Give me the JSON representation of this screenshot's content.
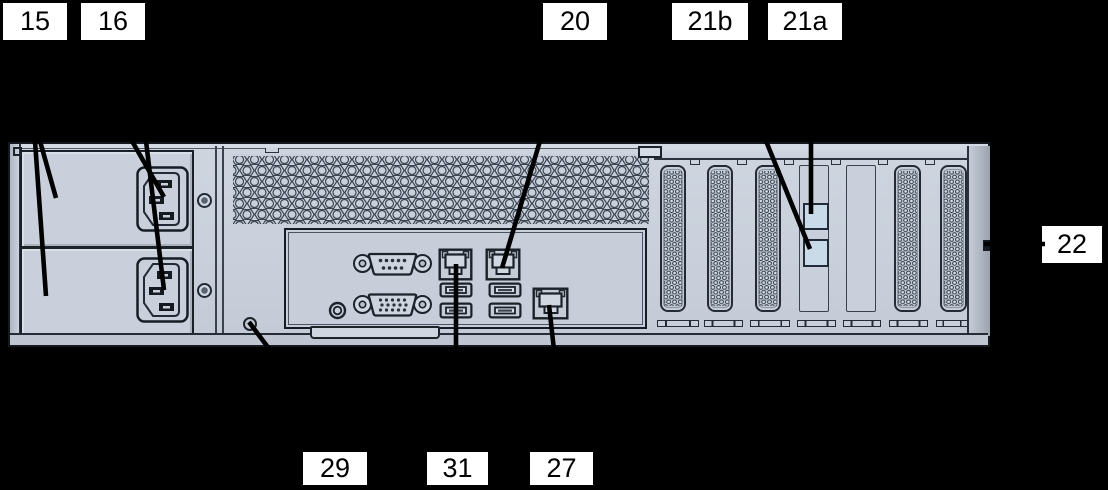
{
  "figure": {
    "kind": "server rear panel callout diagram"
  },
  "colors": {
    "background": "#000000",
    "chassis_fill": "#c9d0db",
    "outline": "#1d232b",
    "shade": "#9ba3b0",
    "port_square_fill": "#c9dae8",
    "label_bg": "#ffffff",
    "label_text": "#000000",
    "leader_line": "#000000"
  },
  "callout_labels": [
    {
      "id": "15",
      "text": "15",
      "x": 3,
      "y": 3,
      "w": 64,
      "h": 37
    },
    {
      "id": "16",
      "text": "16",
      "x": 81,
      "y": 3,
      "w": 64,
      "h": 37
    },
    {
      "id": "20",
      "text": "20",
      "x": 543,
      "y": 3,
      "w": 64,
      "h": 37
    },
    {
      "id": "21b",
      "text": "21b",
      "x": 672,
      "y": 3,
      "w": 76,
      "h": 37
    },
    {
      "id": "21a",
      "text": "21a",
      "x": 768,
      "y": 3,
      "w": 74,
      "h": 37
    },
    {
      "id": "22",
      "text": "22",
      "x": 1042,
      "y": 226,
      "w": 60,
      "h": 37
    },
    {
      "id": "29",
      "text": "29",
      "x": 303,
      "y": 452,
      "w": 64,
      "h": 33
    },
    {
      "id": "31",
      "text": "31",
      "x": 427,
      "y": 452,
      "w": 61,
      "h": 33
    },
    {
      "id": "27",
      "text": "27",
      "x": 530,
      "y": 452,
      "w": 63,
      "h": 33
    }
  ],
  "leader_lines": [
    {
      "label": "15",
      "x1": 40,
      "y1": 141,
      "x2": 56,
      "y2": 198
    },
    {
      "label": "15",
      "x1": 35,
      "y1": 141,
      "x2": 46,
      "y2": 296
    },
    {
      "label": "16",
      "x1": 132,
      "y1": 141,
      "x2": 164,
      "y2": 197
    },
    {
      "label": "16",
      "x1": 146,
      "y1": 141,
      "x2": 164,
      "y2": 290
    },
    {
      "label": "20",
      "x1": 540,
      "y1": 141,
      "x2": 502,
      "y2": 268
    },
    {
      "label": "21b",
      "x1": 766,
      "y1": 141,
      "x2": 810,
      "y2": 249
    },
    {
      "label": "21a",
      "x1": 811,
      "y1": 141,
      "x2": 811,
      "y2": 214
    },
    {
      "label": "22",
      "x1": 984,
      "y1": 244,
      "x2": 1045,
      "y2": 244
    },
    {
      "label": "29",
      "x1": 249,
      "y1": 322,
      "x2": 270,
      "y2": 350
    },
    {
      "label": "31",
      "x1": 456,
      "y1": 264,
      "x2": 456,
      "y2": 350
    },
    {
      "label": "27",
      "x1": 549,
      "y1": 305,
      "x2": 554,
      "y2": 350
    }
  ]
}
